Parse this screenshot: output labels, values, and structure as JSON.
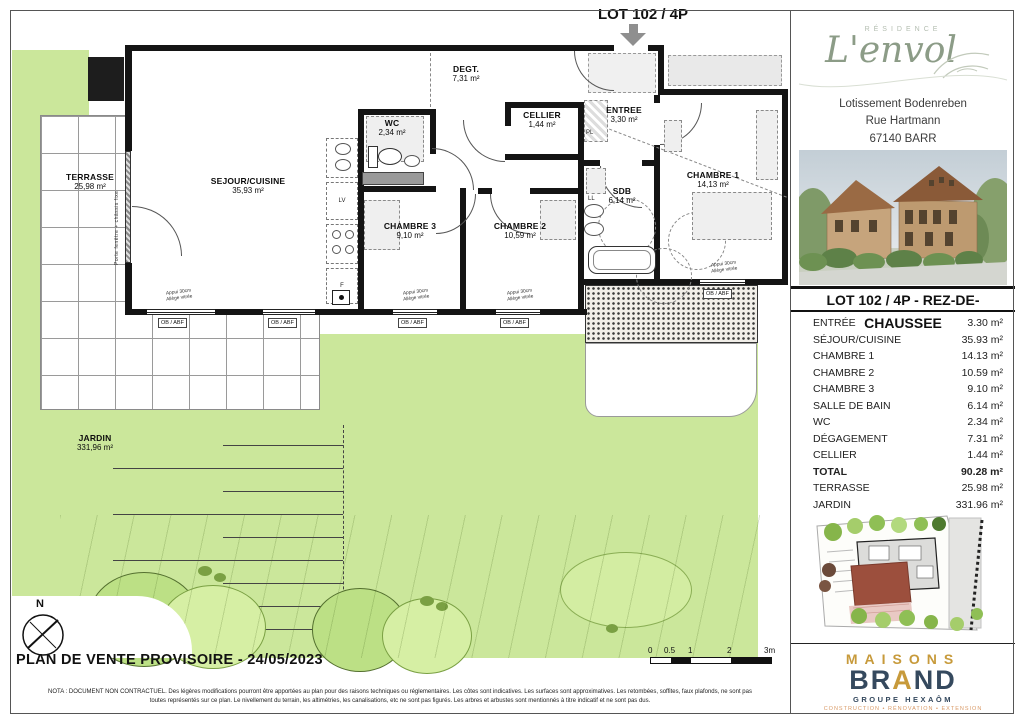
{
  "plan": {
    "lot_title": "LOT 102 / 4P",
    "rooms": [
      {
        "name": "TERRASSE",
        "area": "25,98 m²"
      },
      {
        "name": "SEJOUR/CUISINE",
        "area": "35,93 m²"
      },
      {
        "name": "WC",
        "area": "2,34 m²"
      },
      {
        "name": "DEGT.",
        "area": "7,31 m²"
      },
      {
        "name": "CELLIER",
        "area": "1,44 m²"
      },
      {
        "name": "ENTREE",
        "area": "3,30 m²"
      },
      {
        "name": "SDB",
        "area": "6,14 m²"
      },
      {
        "name": "CHAMBRE 1",
        "area": "14,13 m²"
      },
      {
        "name": "CHAMBRE 2",
        "area": "10,59 m²"
      },
      {
        "name": "CHAMBRE 3",
        "area": "9,10 m²"
      },
      {
        "name": "JARDIN",
        "area": "331,96 m²"
      }
    ],
    "annotations": {
      "window_support": "Appui 30cm",
      "window_glazing": "Allège vitrée",
      "ob_abf": "OB / ABF",
      "porte_fenetre": "Porte fenêtre + châssis fixe",
      "pl": "PL",
      "ll": "LL",
      "lv": "LV",
      "f": "F"
    }
  },
  "footer": {
    "title": "PLAN DE VENTE PROVISOIRE - 24/05/2023",
    "compass": "N",
    "scale_ticks": [
      "0",
      "0.5",
      "1",
      "2",
      "3m"
    ],
    "nota_line1": "NOTA : DOCUMENT NON CONTRACTUEL. Des légères modifications pourront être apportées au plan pour des raisons techniques ou réglementaires. Les côtes sont indicatives. Les surfaces sont approximatives. Les retombées, soffites, faux plafonds, ne sont pas",
    "nota_line2": "toutes représentés sur ce plan. Le nivellement du terrain, les altimétries, les canalisations, etc ne sont pas figurés. Les arbres et arbustes sont mentionnés à titre indicatif et ne sont pas dus."
  },
  "sidebar": {
    "residence_label": "RÉSIDENCE",
    "residence_name": "L'envol",
    "address_line1": "Lotissement Bodenreben",
    "address_line2": "Rue Hartmann",
    "address_line3": "67140 BARR",
    "lot_header": "LOT 102 / 4P - REZ-DE-CHAUSSEE",
    "table_rows": [
      {
        "label": "ENTRÉE",
        "value": "3.30 m²"
      },
      {
        "label": "SÉJOUR/CUISINE",
        "value": "35.93 m²"
      },
      {
        "label": "CHAMBRE 1",
        "value": "14.13 m²"
      },
      {
        "label": "CHAMBRE 2",
        "value": "10.59 m²"
      },
      {
        "label": "CHAMBRE 3",
        "value": "9.10 m²"
      },
      {
        "label": "SALLE DE BAIN",
        "value": "6.14 m²"
      },
      {
        "label": "WC",
        "value": "2.34 m²"
      },
      {
        "label": "DÉGAGEMENT",
        "value": "7.31 m²"
      },
      {
        "label": "CELLIER",
        "value": "1.44 m²"
      },
      {
        "label": "TOTAL",
        "value": "90.28 m²"
      },
      {
        "label": "TERRASSE",
        "value": "25.98 m²"
      },
      {
        "label": "JARDIN",
        "value": "331.96 m²"
      }
    ],
    "brand": {
      "maisons": "MAISONS",
      "brand_b": "BR",
      "brand_a": "A",
      "brand_nd": "ND",
      "groupe": "GROUPE HEXAÔM",
      "tagline": "CONSTRUCTION • RÉNOVATION • EXTENSION"
    }
  },
  "colors": {
    "garden_green": "#cbe79b",
    "brand_gold": "#c79a3b",
    "brand_navy": "#35495e",
    "tagline_orange": "#d99a67"
  }
}
